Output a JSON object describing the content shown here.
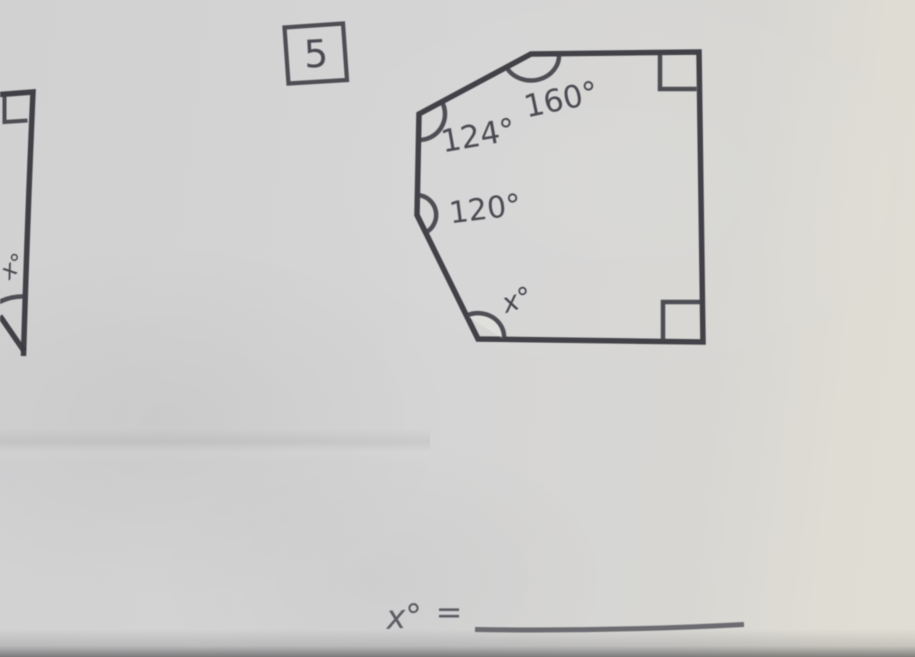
{
  "problem": {
    "number": "5"
  },
  "figure_left": {
    "angle_label": "x°"
  },
  "figure_hexagon": {
    "angle_top": "160°",
    "angle_upper_left": "124°",
    "angle_left": "120°",
    "angle_bottom": "x°"
  },
  "answer": {
    "label": "x°",
    "equals": "="
  },
  "colors": {
    "ink": "#3a3a41",
    "paper": "#d5d5d5",
    "paper_right": "#e0ded4"
  }
}
